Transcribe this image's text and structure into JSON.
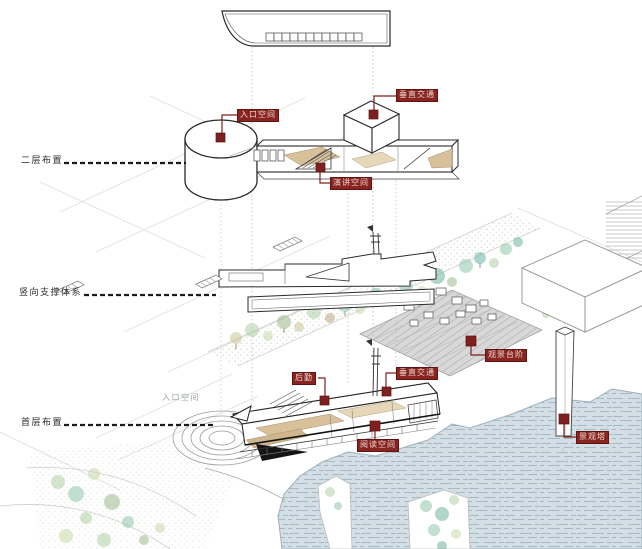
{
  "diagram": {
    "section_labels": [
      {
        "label": "二层布置"
      },
      {
        "label": "竖向支撑体系"
      },
      {
        "label": "首层布置"
      }
    ],
    "tags": [
      {
        "label": "入口空间"
      },
      {
        "label": "垂直交通"
      },
      {
        "label": "演讲空间"
      },
      {
        "label": "观景台阶"
      },
      {
        "label": "垂直交通"
      },
      {
        "label": "后勤"
      },
      {
        "label": "阅读空间"
      },
      {
        "label": "景观塔"
      }
    ],
    "ground_label": "入口空间",
    "colors": {
      "tag_red": "#8a2421",
      "marker_red": "#7d201e",
      "floor_tan": "#d8c19a",
      "water_blue": "#d3dee5",
      "tree_green": "#8fc7ab"
    }
  }
}
